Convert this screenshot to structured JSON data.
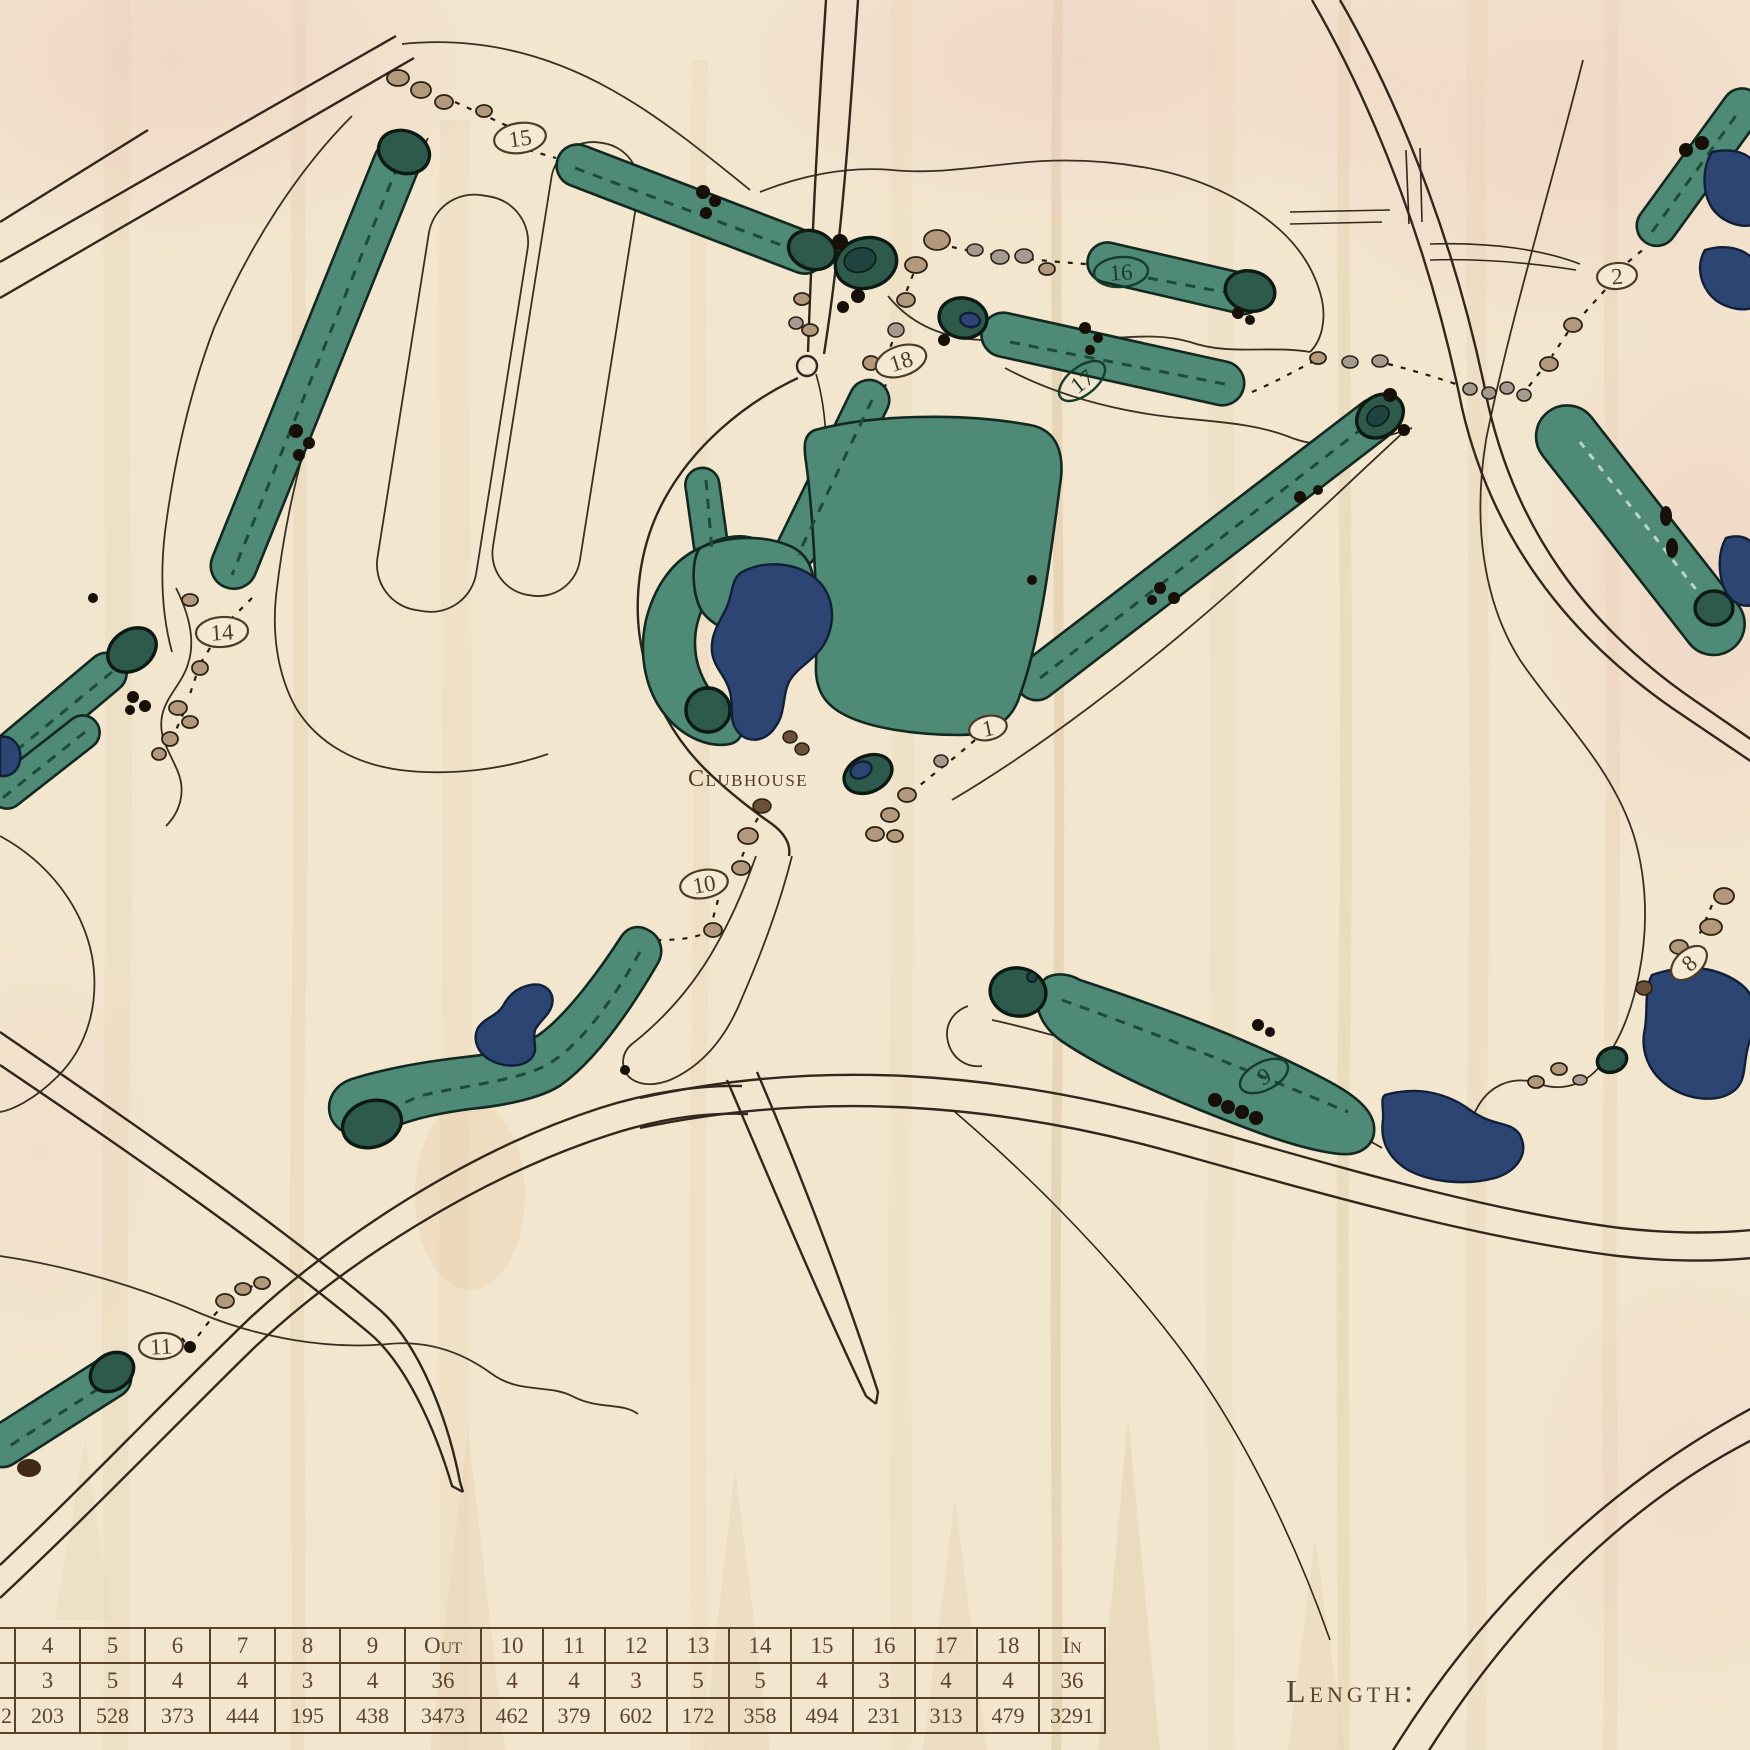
{
  "map": {
    "clubhouse_label": "Clubhouse",
    "length_label": "Length:",
    "hole_markers": [
      {
        "label": "15"
      },
      {
        "label": "16"
      },
      {
        "label": "17"
      },
      {
        "label": "18"
      },
      {
        "label": "14"
      },
      {
        "label": "2"
      },
      {
        "label": "1"
      },
      {
        "label": "10"
      },
      {
        "label": "11"
      },
      {
        "label": "9"
      },
      {
        "label": "8"
      }
    ],
    "colors": {
      "wood": "#f2e6cf",
      "fairway": "#4e8a75",
      "green": "#2d5a4a",
      "water": "#2c4572",
      "sand": "#b3997b",
      "engrave_brown": "#5a4128",
      "line": "#31271c"
    }
  },
  "scorecard": {
    "rows": [
      {
        "name": "hole",
        "cells": [
          "",
          "4",
          "5",
          "6",
          "7",
          "8",
          "9",
          "Out",
          "10",
          "11",
          "12",
          "13",
          "14",
          "15",
          "16",
          "17",
          "18",
          "In"
        ]
      },
      {
        "name": "par",
        "cells": [
          "",
          "3",
          "5",
          "4",
          "4",
          "3",
          "4",
          "36",
          "4",
          "4",
          "3",
          "5",
          "5",
          "4",
          "3",
          "4",
          "4",
          "36"
        ]
      },
      {
        "name": "length",
        "cells": [
          "2",
          "203",
          "528",
          "373",
          "444",
          "195",
          "438",
          "3473",
          "462",
          "379",
          "602",
          "172",
          "358",
          "494",
          "231",
          "313",
          "479",
          "3291"
        ]
      }
    ]
  }
}
